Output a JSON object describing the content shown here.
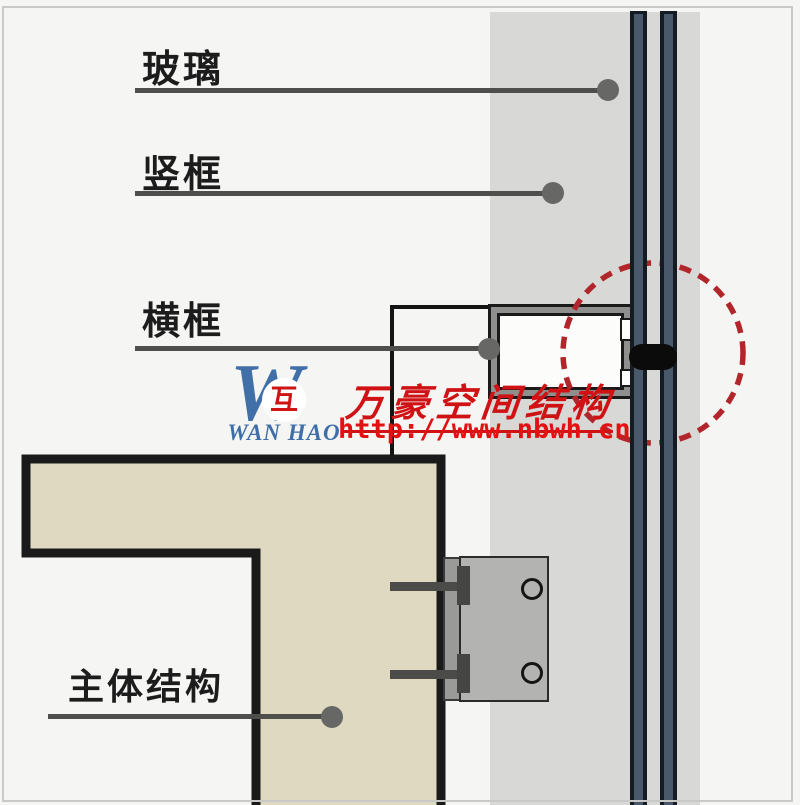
{
  "diagram": {
    "type": "curtain-wall-section-detail",
    "callouts": [
      {
        "id": "glass",
        "label": "玻璃"
      },
      {
        "id": "mullion",
        "label": "竖框"
      },
      {
        "id": "transom",
        "label": "横框"
      },
      {
        "id": "structure",
        "label": "主体结构"
      }
    ],
    "colors": {
      "background": "#f5f5f3",
      "panel_gray": "#d8d8d6",
      "glass_slate": "#49596b",
      "glass_edge": "#141b22",
      "transom_band": "#8f8f8d",
      "structure_beige": "#ded9c0",
      "outline_black": "#1a1a1a",
      "bracket_gray": "#b3b3b1",
      "leader_gray": "#4e4e4c",
      "highlight_red": "#b0262a",
      "watermark_red": "#d01214",
      "watermark_blue": "#4170a9"
    },
    "icons": {
      "highlight_circle": "dashed-red-circle-icon",
      "joint_gasket": "black-gasket-blob"
    }
  },
  "watermark": {
    "logo_letter": "W",
    "logo_symbol": "互",
    "logo_name": "WAN HAO",
    "company": "万豪空间结构",
    "url": "http://www.nbwh.cn"
  }
}
